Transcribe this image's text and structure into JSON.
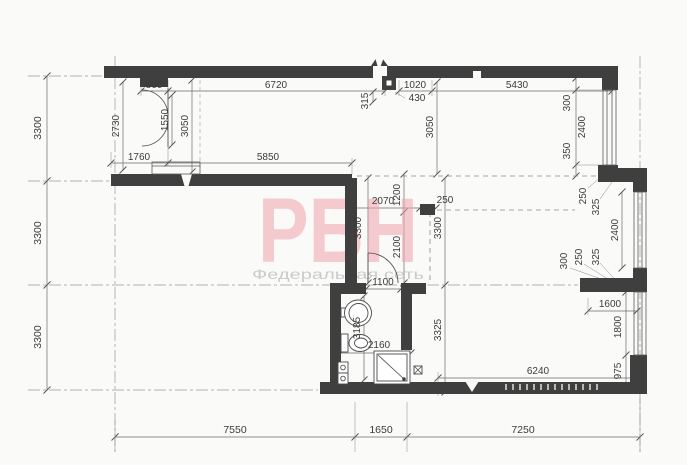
{
  "watermark": {
    "logo": "РБН",
    "subtitle": "Федеральная сеть",
    "logo_color": "#f0a3ac",
    "subtitle_color": "#c6c6c6"
  },
  "palette": {
    "wall": "#3f3f3f",
    "dimension_line": "#6b6b6b",
    "dimension_text": "#3c3c3c",
    "background": "#fafaf8"
  },
  "axis_dims": {
    "left": [
      "3300",
      "3300",
      "3300"
    ],
    "bottom": [
      "7550",
      "1650",
      "7250"
    ]
  },
  "room_dims": {
    "top_left": {
      "door": "860",
      "top": "6720",
      "left": "2730",
      "door_span": "1550",
      "depth": "3050",
      "offset": "1760",
      "bottom": "5850"
    },
    "top_center": {
      "pier": "315",
      "entry": "1020",
      "niche": "430"
    },
    "top_right": {
      "top": "5430",
      "depth": "3050",
      "win_top": "300",
      "window": "2400",
      "win_bottom": "350",
      "jamb": "250",
      "jamb2": "325"
    },
    "center": {
      "opening": "2070",
      "pier": "1200",
      "stub": "250",
      "left": "3300",
      "right": "3300",
      "door": "2100"
    },
    "mid_right": {
      "w300": "300",
      "w250": "250",
      "w325": "325",
      "window": "2400",
      "ledge": "1600"
    },
    "bottom_right": {
      "window": "1800",
      "corner": "975",
      "bottom": "6240"
    },
    "bathroom": {
      "door": "1100",
      "side": "3185",
      "width": "2160",
      "hall": "3325"
    }
  }
}
